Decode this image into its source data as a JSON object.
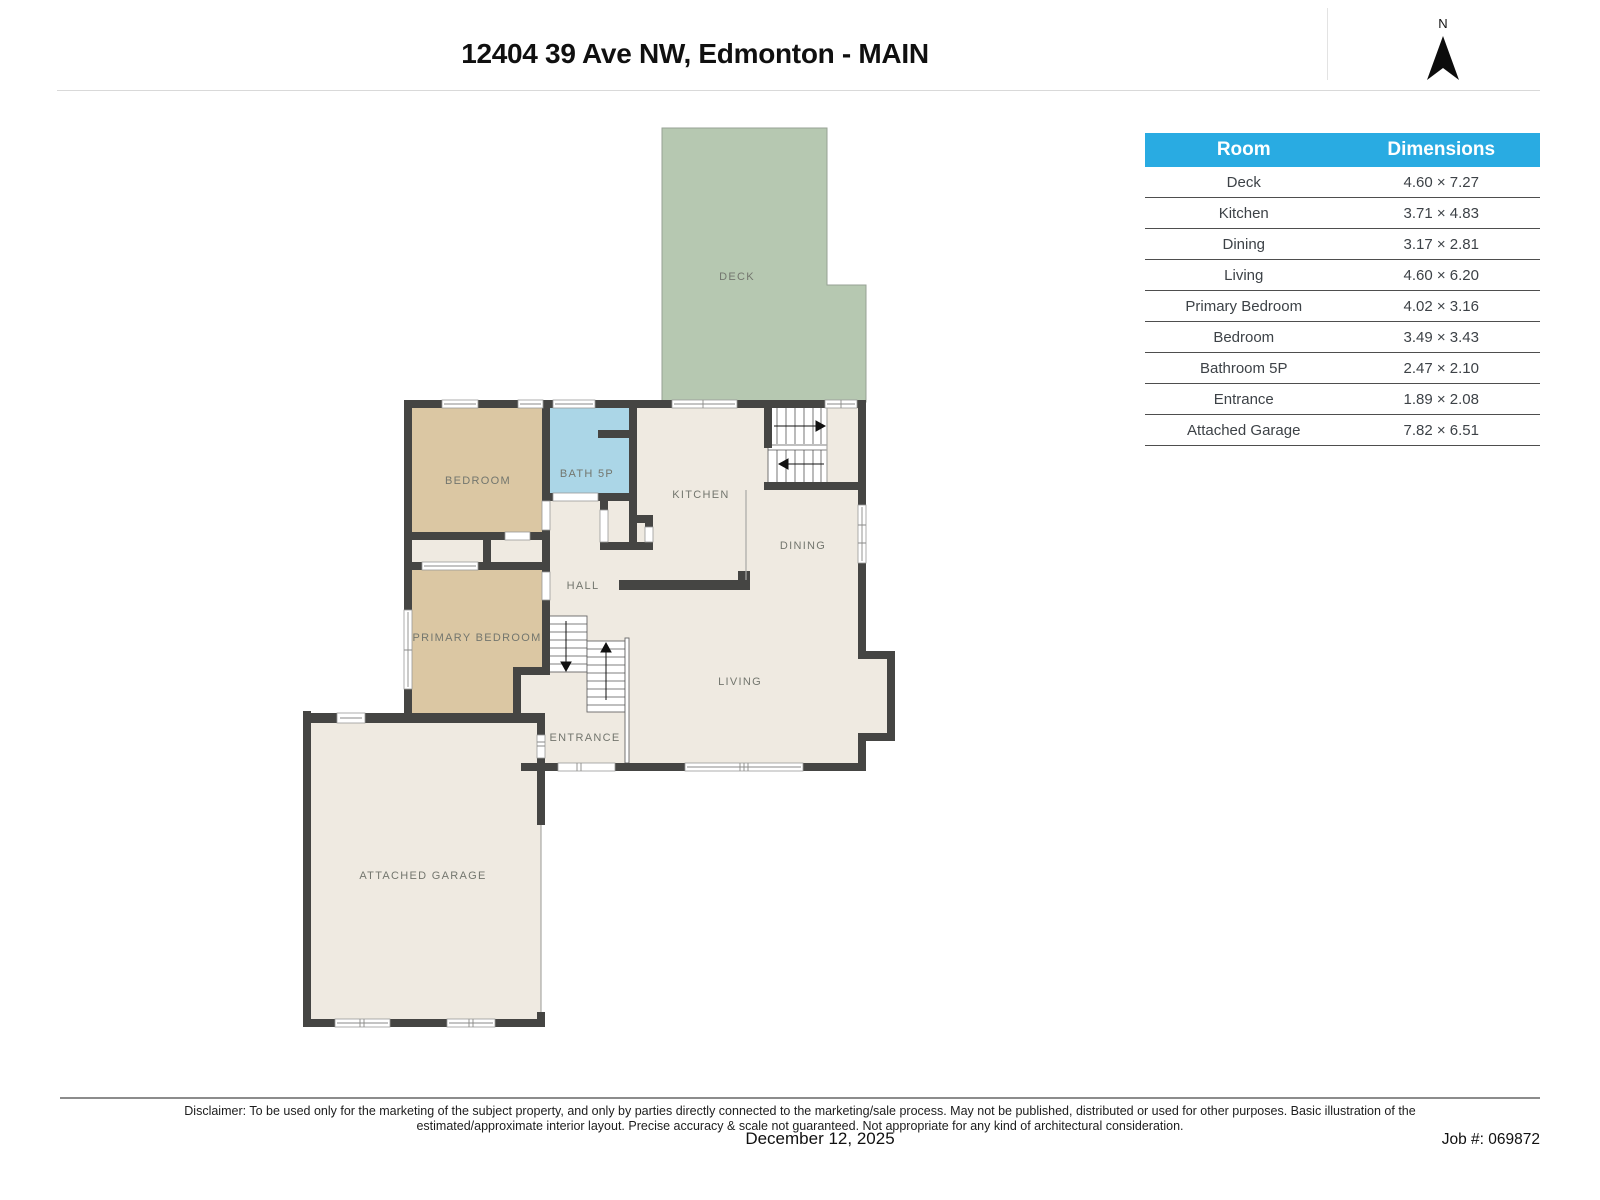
{
  "header": {
    "title": "12404 39 Ave NW, Edmonton - MAIN",
    "compass_label": "N"
  },
  "table": {
    "columns": [
      "Room",
      "Dimensions"
    ],
    "rows": [
      {
        "room": "Deck",
        "dimensions": "4.60 × 7.27"
      },
      {
        "room": "Kitchen",
        "dimensions": "3.71 × 4.83"
      },
      {
        "room": "Dining",
        "dimensions": "3.17 × 2.81"
      },
      {
        "room": "Living",
        "dimensions": "4.60 × 6.20"
      },
      {
        "room": "Primary Bedroom",
        "dimensions": "4.02 × 3.16"
      },
      {
        "room": "Bedroom",
        "dimensions": "3.49 × 3.43"
      },
      {
        "room": "Bathroom 5P",
        "dimensions": "2.47 × 2.10"
      },
      {
        "room": "Entrance",
        "dimensions": "1.89 × 2.08"
      },
      {
        "room": "Attached Garage",
        "dimensions": "7.82 × 6.51"
      }
    ]
  },
  "plan": {
    "labels": [
      {
        "id": "deck",
        "text": "DECK"
      },
      {
        "id": "bedroom",
        "text": "BEDROOM"
      },
      {
        "id": "bath-5p",
        "text": "BATH 5P"
      },
      {
        "id": "kitchen",
        "text": "KITCHEN"
      },
      {
        "id": "dining",
        "text": "DINING"
      },
      {
        "id": "hall",
        "text": "HALL"
      },
      {
        "id": "primary-bedroom",
        "text": "PRIMARY BEDROOM"
      },
      {
        "id": "living",
        "text": "LIVING"
      },
      {
        "id": "entrance",
        "text": "ENTRANCE"
      },
      {
        "id": "attached-garage",
        "text": "ATTACHED GARAGE"
      }
    ]
  },
  "footer": {
    "disclaimer": "Disclaimer: To be used only for the marketing of the subject property, and only by parties directly connected to the marketing/sale process. May not be published, distributed or used for other purposes. Basic illustration of the estimated/approximate interior layout. Precise accuracy & scale not guaranteed. Not appropriate for any kind of architectural consideration.",
    "date": "December 12, 2025",
    "job_number": "Job #: 069872"
  },
  "colors": {
    "accent": "#29abe2",
    "wall": "#454543",
    "floor": "#efeae1",
    "bedroom_floor": "#dbc7a3",
    "bath_floor": "#abd6e7",
    "deck_floor": "#b6c8b1"
  }
}
